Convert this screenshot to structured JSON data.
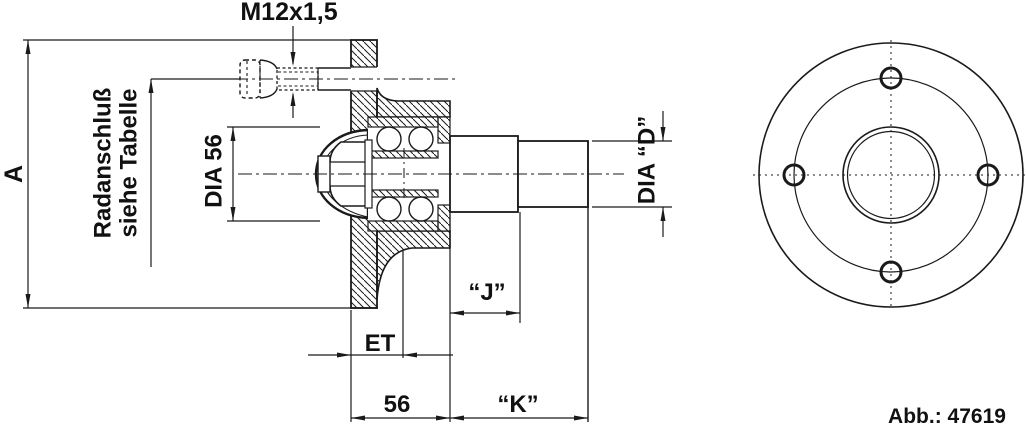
{
  "drawing": {
    "title": "wheel-hub-technical-drawing",
    "labels": {
      "thread": "M12x1,5",
      "dim_a": "A",
      "wheel_mount_1": "Radanschluß",
      "wheel_mount_2": "siehe Tabelle",
      "dia_56": "DIA 56",
      "dia_d": "DIA “D”",
      "dim_j": "“J”",
      "dim_et": "ET",
      "dim_56": "56",
      "dim_k": "“K”",
      "figure_ref": "Abb.: 47619"
    },
    "colors": {
      "line": "#1a1a1a",
      "background": "#ffffff"
    }
  }
}
